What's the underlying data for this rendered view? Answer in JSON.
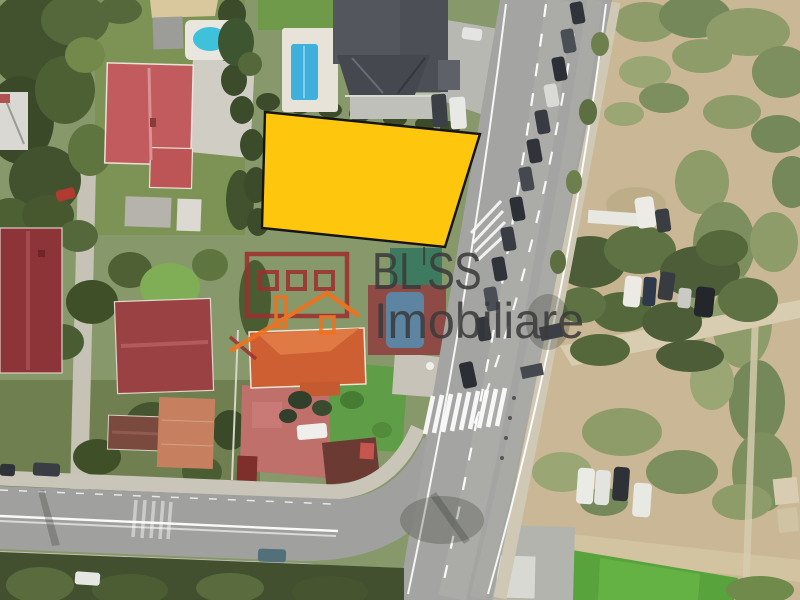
{
  "watermark": {
    "brand_parts": [
      "BL",
      "I",
      "SS"
    ],
    "brand_full": "BLISS",
    "subtitle": "Imobiliare"
  },
  "theme": {
    "parcel_fill": "#ffc60e",
    "parcel_stroke": "#141414",
    "brand_text": "#3b3b3b",
    "logo_wall": "#9d3030",
    "logo_roof": "#f2701d",
    "base_green": "#8a9a6c",
    "road_gray": "#a4a4a2",
    "dirt_tan": "#c9b795"
  },
  "map": {
    "description_labels": {
      "parcel": "highlighted land plot for sale",
      "scene": "aerial satellite view of residential corner with road junction"
    },
    "parcel": {
      "points": "265,112 480,134 445,247 262,228"
    }
  }
}
